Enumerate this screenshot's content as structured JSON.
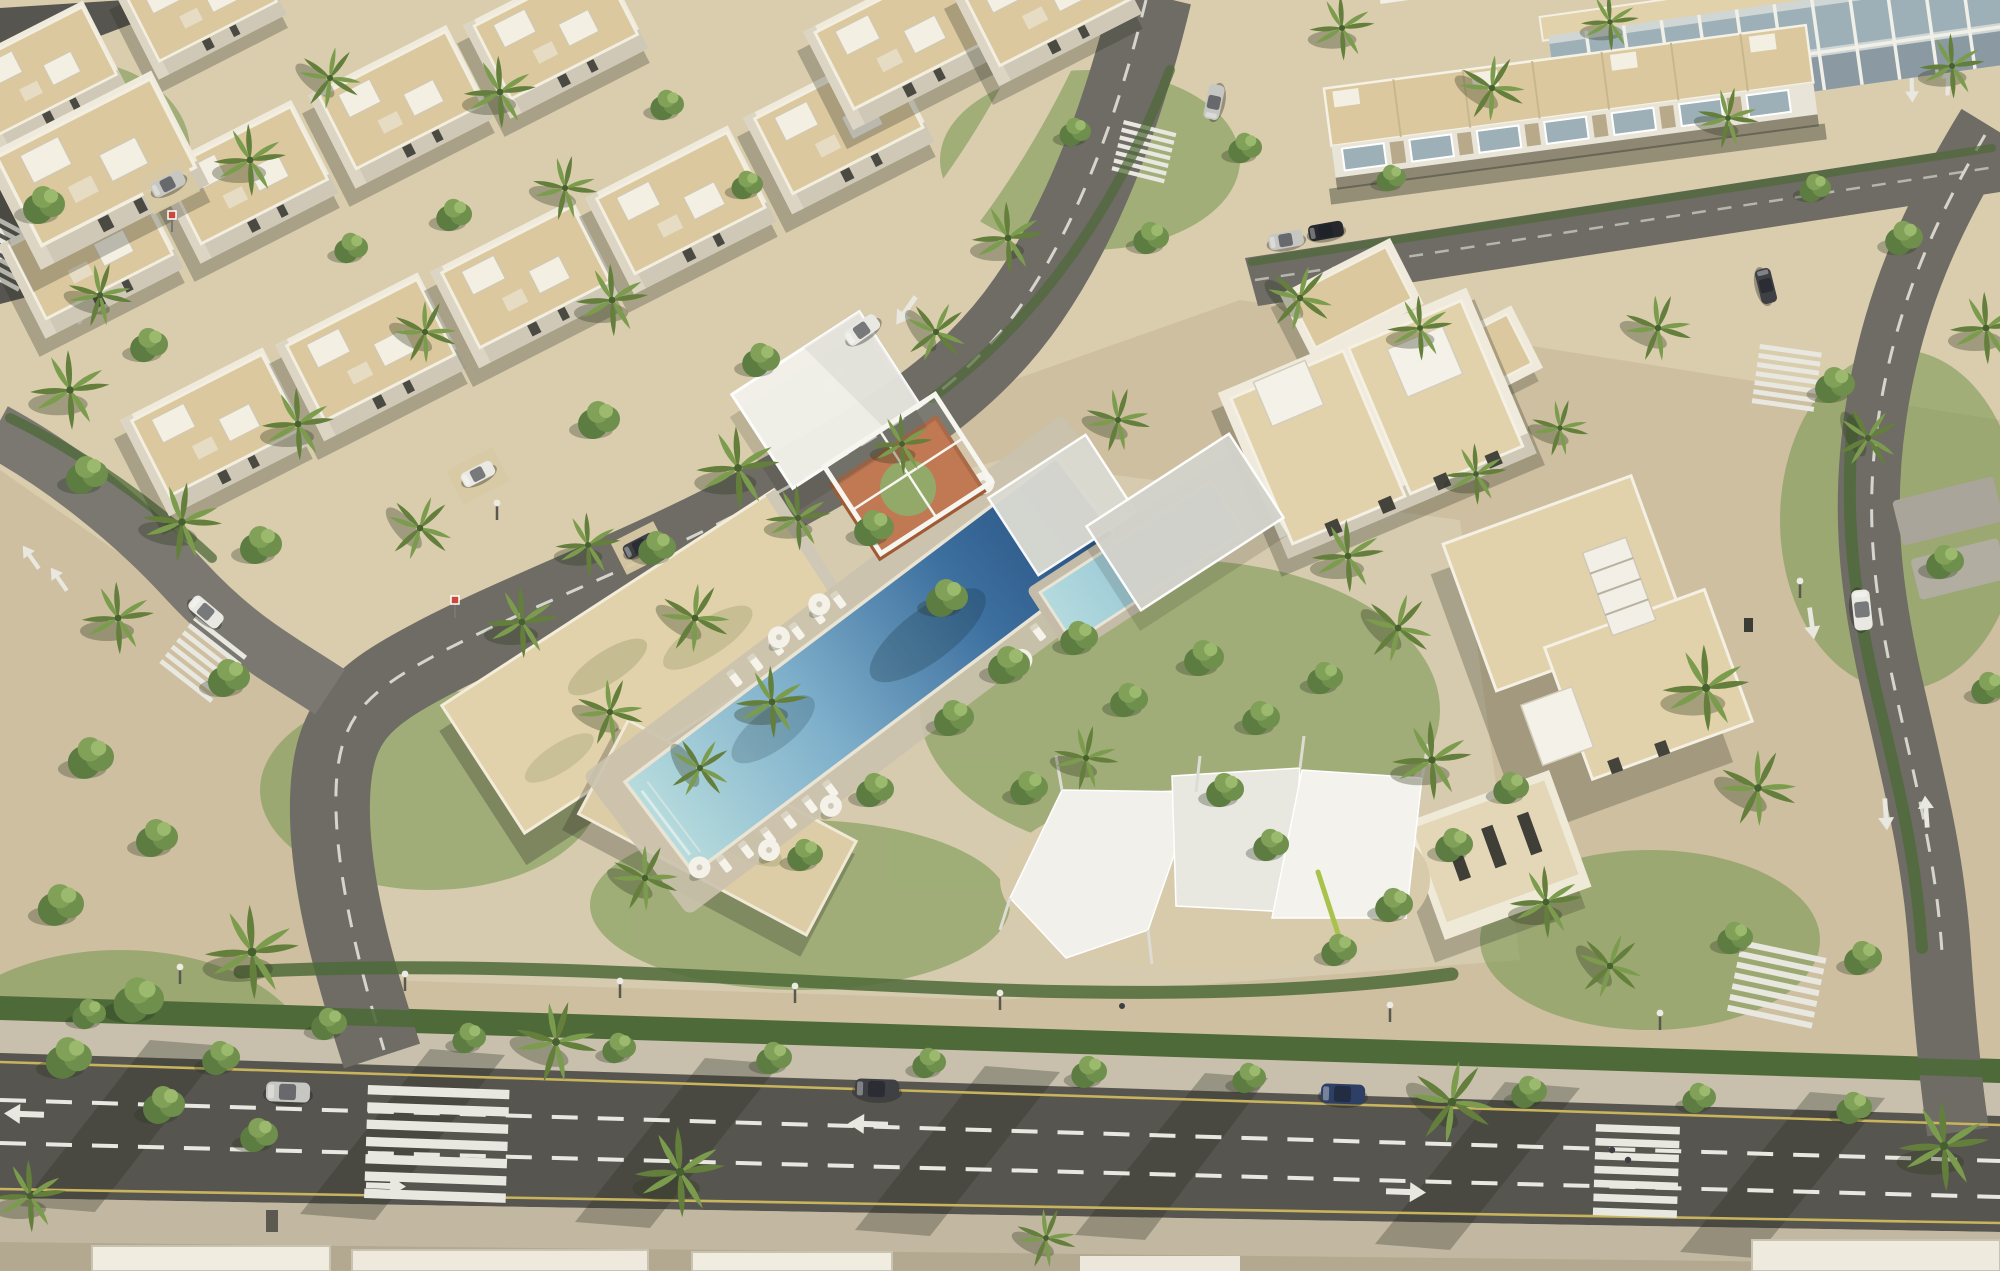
{
  "scene": {
    "title": "Aerial rendering of a palm-lined villa community with central pool amenity",
    "description": "Photorealistic bird's-eye architectural rendering: diagonal rows of flat-roofed white villas with beige rooftops in the north-west, glass-fronted townhouse rows in the north-east, and a landscaped central amenity courtyard containing an L-shaped clubhouse, a long rectangular lap pool with sun loungers and umbrellas, a covered kids pool, white pergola frames over an orange play court, and three white shade sails over a sand play area. A wide boulevard with lane markings, crosswalks and parked cars crosses the south edge; curving internal streets with palms and hedges connect the districts.",
    "view": "aerial three-quarter, sunlight from upper right, shadows to lower left",
    "time_of_day": "midday"
  },
  "palette": {
    "sand": "#cdbfa0",
    "sand_light": "#d9cdae",
    "pavement": "#c8c0ac",
    "sidewalk": "#c2b8a1",
    "asphalt": "#6e6c64",
    "asphalt_light": "#7a7871",
    "asphalt_dark": "#57554f",
    "lane_white": "#e8e7e0",
    "lane_yellow": "#c9b45e",
    "hedge_green": "#4e6a38",
    "lawn_green": "#7b9a54",
    "tree_dark": "#5d7c41",
    "tree_mid": "#6f8f4c",
    "tree_light": "#81a159",
    "tree_hi": "#9cba6d",
    "palm_green": "#7c9c4d",
    "palm_dark": "#647f3c",
    "wall_lit": "#efeadb",
    "wall_shade": "#cfc8b6",
    "wall_west": "#ddd5c3",
    "roof_beige": "#dbc89f",
    "roof_beige_light": "#e2d2ab",
    "glass_blue": "#9db0b8",
    "canopy_white": "#f2f1ea",
    "canopy_grey": "#d3d3cb",
    "play_orange": "#b96a40",
    "play_green": "#87a058",
    "pool_shallow": "#a7d4da",
    "pool_mid": "#5f93bb",
    "pool_deep": "#2d5f92",
    "car_silver": "#c6c6c2",
    "car_dark": "#3e4044",
    "car_black": "#26282c",
    "car_blue": "#2e3f66",
    "car_white": "#e9e8e3"
  },
  "inventory": {
    "districts": [
      {
        "name": "villa-district-northwest",
        "building_type": "detached white villas, beige flat roofs",
        "villas_visible": 14
      },
      {
        "name": "townhouse-district-northeast",
        "building_type": "townhouse rows with glazed balconies",
        "rows": 3
      },
      {
        "name": "villa-cluster-east",
        "building_type": "large villas with roof terraces",
        "villas_visible": 4
      },
      {
        "name": "amenity-center",
        "features": [
          "clubhouse",
          "lap pool",
          "kids pool",
          "pergolas",
          "shade sails",
          "play court",
          "gardens"
        ]
      }
    ],
    "amenity": {
      "lap_pool": {
        "shape": "long rectangle",
        "orientation_deg": -37,
        "water_colors": [
          "#a7d4da",
          "#5f93bb",
          "#2d5f92"
        ]
      },
      "kids_pool": {
        "covered_by": "grey canopy"
      },
      "pergola_canopies": 4,
      "shade_sails": 3,
      "play_court": {
        "surface": "#b96a40",
        "circle": "#87a058"
      },
      "sun_loungers": 13,
      "umbrellas": 7,
      "clubhouse": {
        "shape": "L",
        "roof_color": "#e2d2ab"
      }
    },
    "vehicles": [
      {
        "type": "suv",
        "color": "silver",
        "location": "boulevard parking"
      },
      {
        "type": "suv",
        "color": "dark-grey",
        "location": "boulevard parking"
      },
      {
        "type": "suv",
        "color": "blue",
        "location": "boulevard parking"
      },
      {
        "type": "suv",
        "color": "white",
        "location": "east road"
      },
      {
        "type": "car",
        "color": "dark",
        "location": "east road upper"
      },
      {
        "type": "car",
        "color": "silver",
        "location": "northeast street"
      },
      {
        "type": "car",
        "color": "black",
        "location": "northeast street"
      },
      {
        "type": "car",
        "color": "grey",
        "location": "center street"
      },
      {
        "type": "car",
        "color": "white",
        "location": "center street"
      },
      {
        "type": "car",
        "color": "white",
        "location": "west road"
      },
      {
        "type": "car",
        "color": "silver",
        "location": "corner villa carport"
      },
      {
        "type": "car",
        "color": "white",
        "location": "villa carport"
      },
      {
        "type": "car",
        "color": "dark",
        "location": "villa carport"
      }
    ],
    "roads": {
      "boulevard": {
        "position": "south edge",
        "markings": [
          "yellow edge lines",
          "white dashed lanes",
          "direction arrows"
        ],
        "crosswalks": 2
      },
      "center_street": {
        "route": "curves from top edge to boulevard",
        "markings": [
          "dashed centerline",
          "arrows"
        ],
        "crosswalks": 1
      },
      "east_road": {
        "markings": [
          "dashed centerline",
          "up and down arrows"
        ],
        "crosswalks": 2
      },
      "west_road": {
        "crosswalks": 1
      },
      "corner_crosswalks": 2,
      "total_crosswalks": 8
    },
    "vegetation": {
      "palm_trees": 52,
      "canopy_trees": 60,
      "hedges": true,
      "lawns": true
    },
    "street_furniture": {
      "street_lamps": 9,
      "signs": 2,
      "bins": 2,
      "pedestrians": 3
    }
  }
}
